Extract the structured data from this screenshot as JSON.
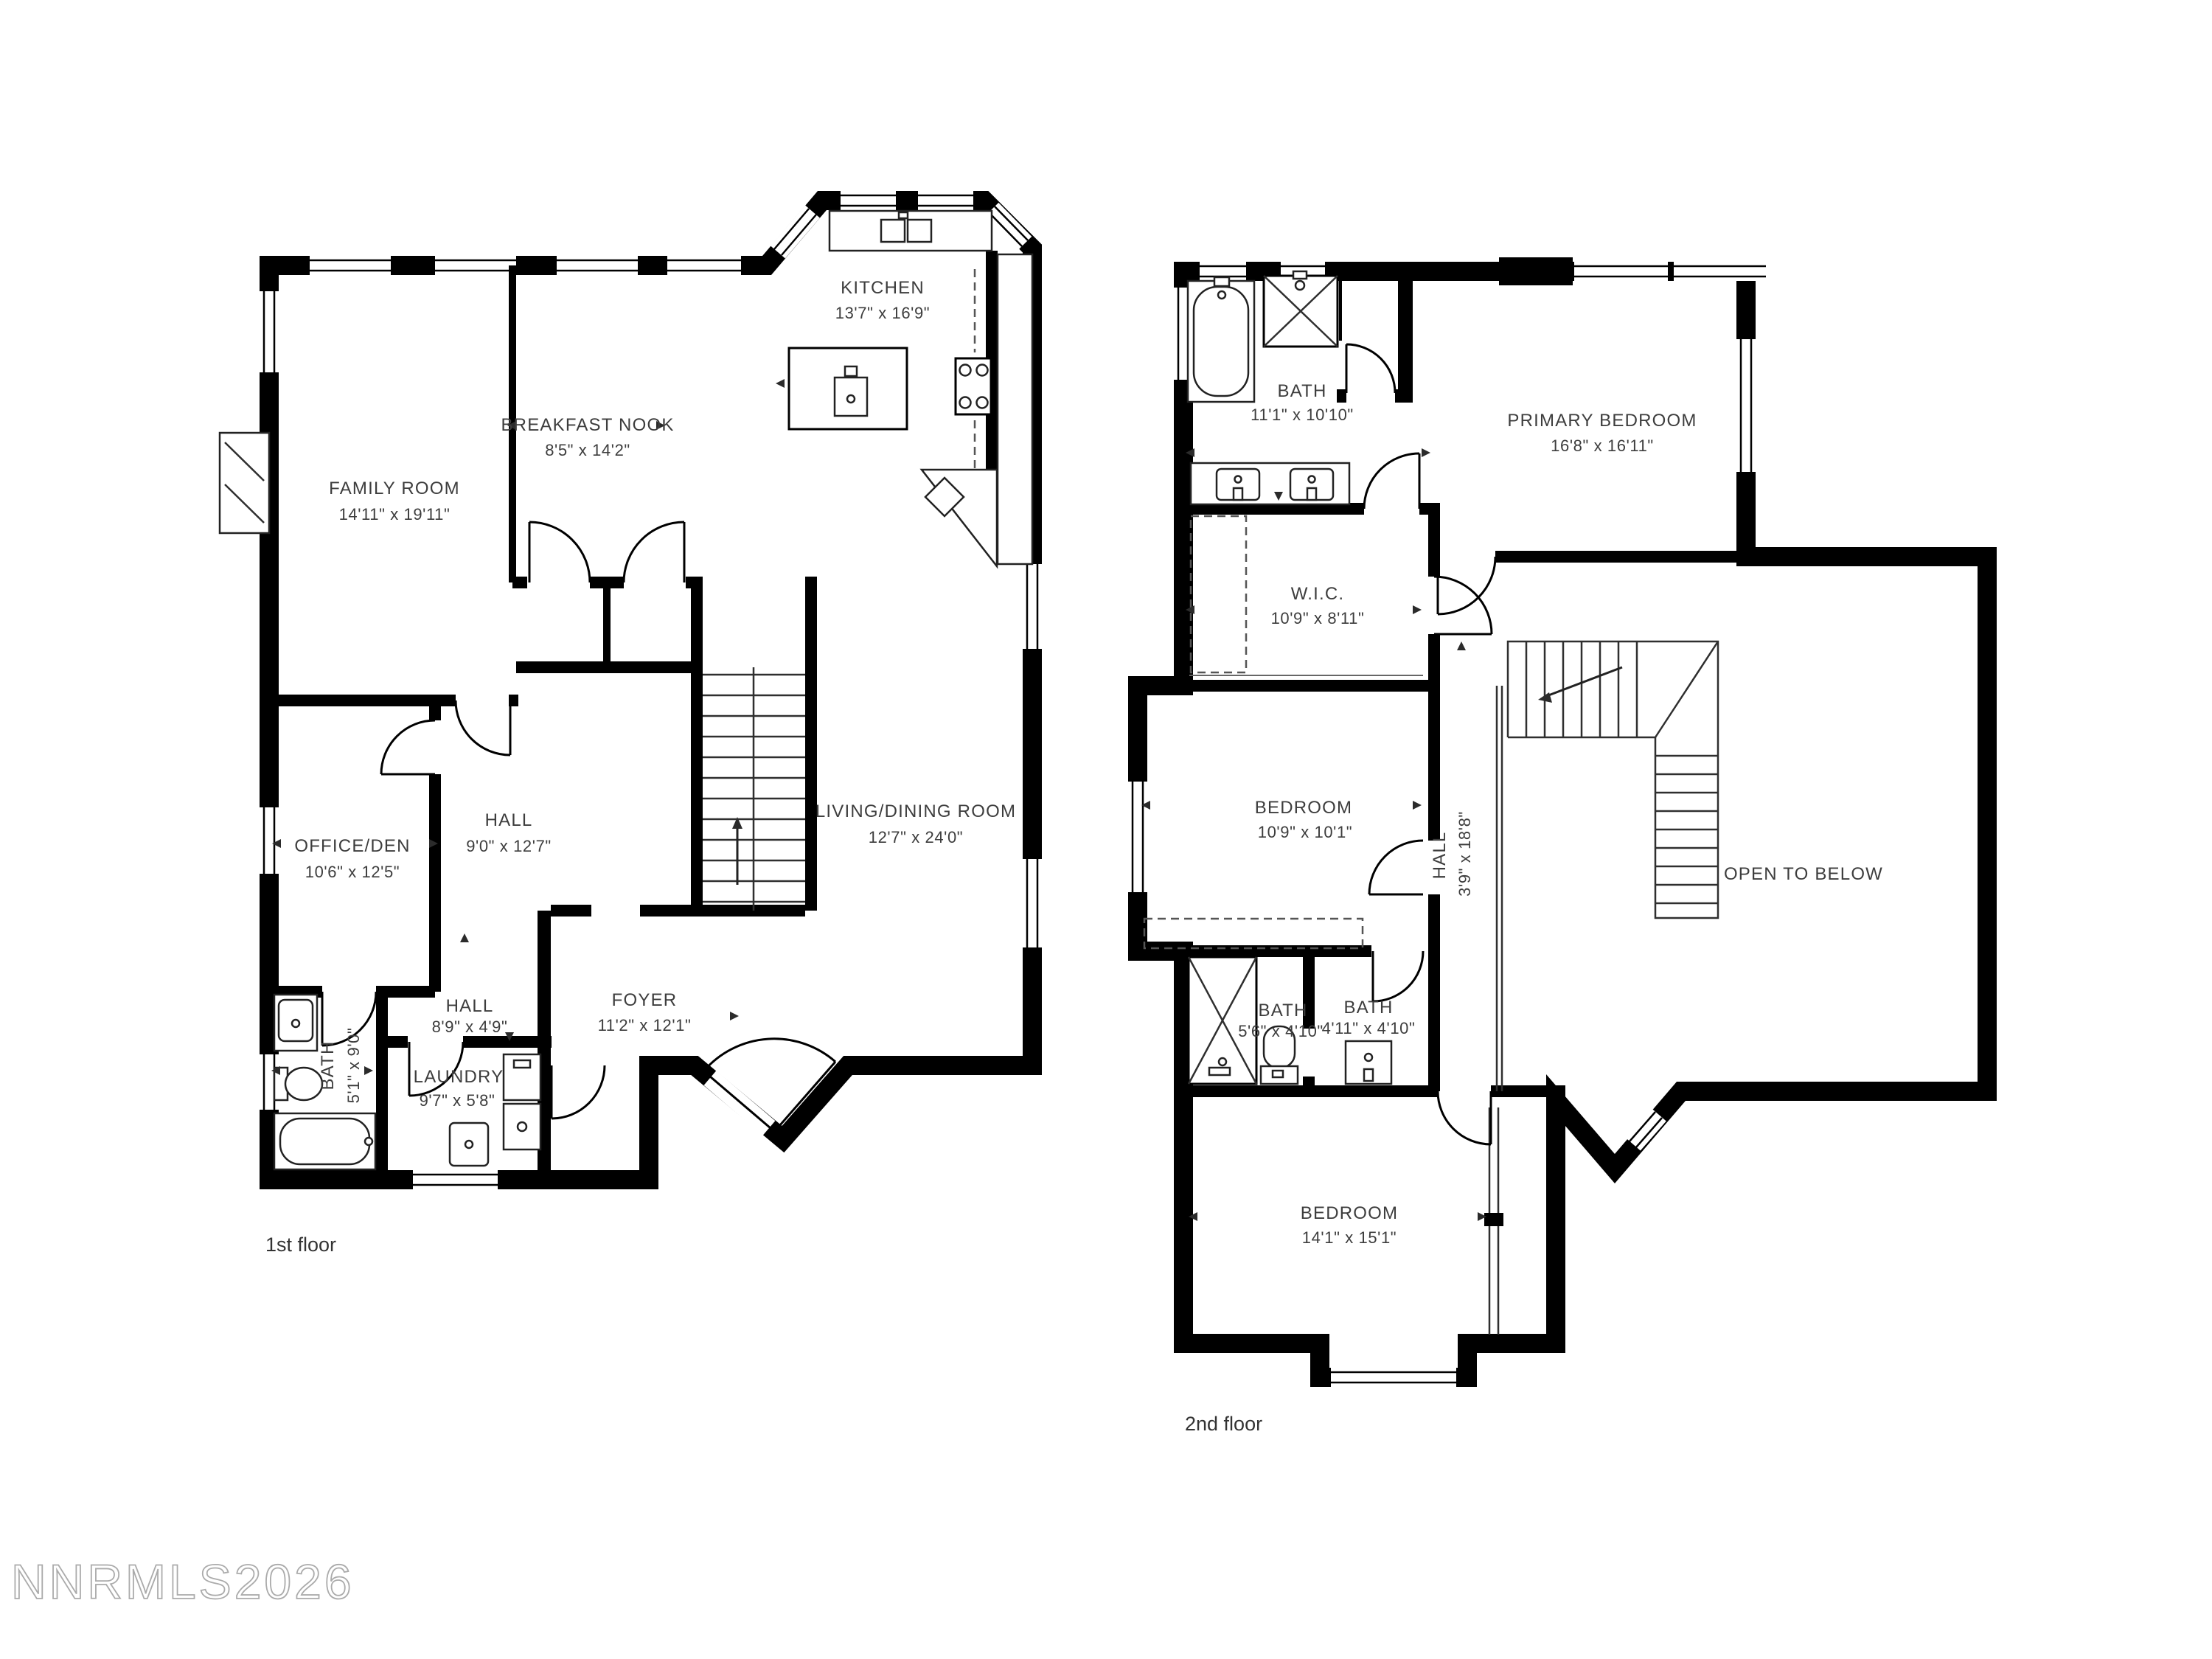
{
  "colors": {
    "walls": "#000000",
    "label_text": "#3d3d3d",
    "watermark_stroke": "#ababab",
    "background": "#ffffff"
  },
  "floor1": {
    "label": "1st floor",
    "rooms": {
      "kitchen": {
        "name": "KITCHEN",
        "dims": "13'7\" x 16'9\""
      },
      "breakfast_nook": {
        "name": "BREAKFAST NOOK",
        "dims": "8'5\" x 14'2\""
      },
      "family_room": {
        "name": "FAMILY ROOM",
        "dims": "14'11\" x 19'11\""
      },
      "office_den": {
        "name": "OFFICE/DEN",
        "dims": "10'6\" x 12'5\""
      },
      "hall": {
        "name": "HALL",
        "dims": "9'0\" x 12'7\""
      },
      "living_dining": {
        "name": "LIVING/DINING ROOM",
        "dims": "12'7\" x 24'0\""
      },
      "hall_lower": {
        "name": "HALL",
        "dims": "8'9\" x 4'9\""
      },
      "foyer": {
        "name": "FOYER",
        "dims": "11'2\" x 12'1\""
      },
      "laundry": {
        "name": "LAUNDRY",
        "dims": "9'7\" x 5'8\""
      },
      "bath": {
        "name": "BATH",
        "dims": "5'1\" x 9'0\""
      }
    }
  },
  "floor2": {
    "label": "2nd floor",
    "rooms": {
      "bath": {
        "name": "BATH",
        "dims": "11'1\" x 10'10\""
      },
      "primary_bedroom": {
        "name": "PRIMARY BEDROOM",
        "dims": "16'8\" x 16'11\""
      },
      "wic": {
        "name": "W.I.C.",
        "dims": "10'9\" x 8'11\""
      },
      "bedroom_mid": {
        "name": "BEDROOM",
        "dims": "10'9\" x 10'1\""
      },
      "hall": {
        "name": "HALL",
        "dims": "3'9\" x 18'8\""
      },
      "open_to_below": {
        "name": "OPEN TO BELOW"
      },
      "bath_left": {
        "name": "BATH",
        "dims": "5'6\" x 4'10\""
      },
      "bath_right": {
        "name": "BATH",
        "dims": "4'11\" x 4'10\""
      },
      "bedroom_lower": {
        "name": "BEDROOM",
        "dims": "14'1\" x 15'1\""
      }
    }
  },
  "watermark": "NNRMLS2026"
}
